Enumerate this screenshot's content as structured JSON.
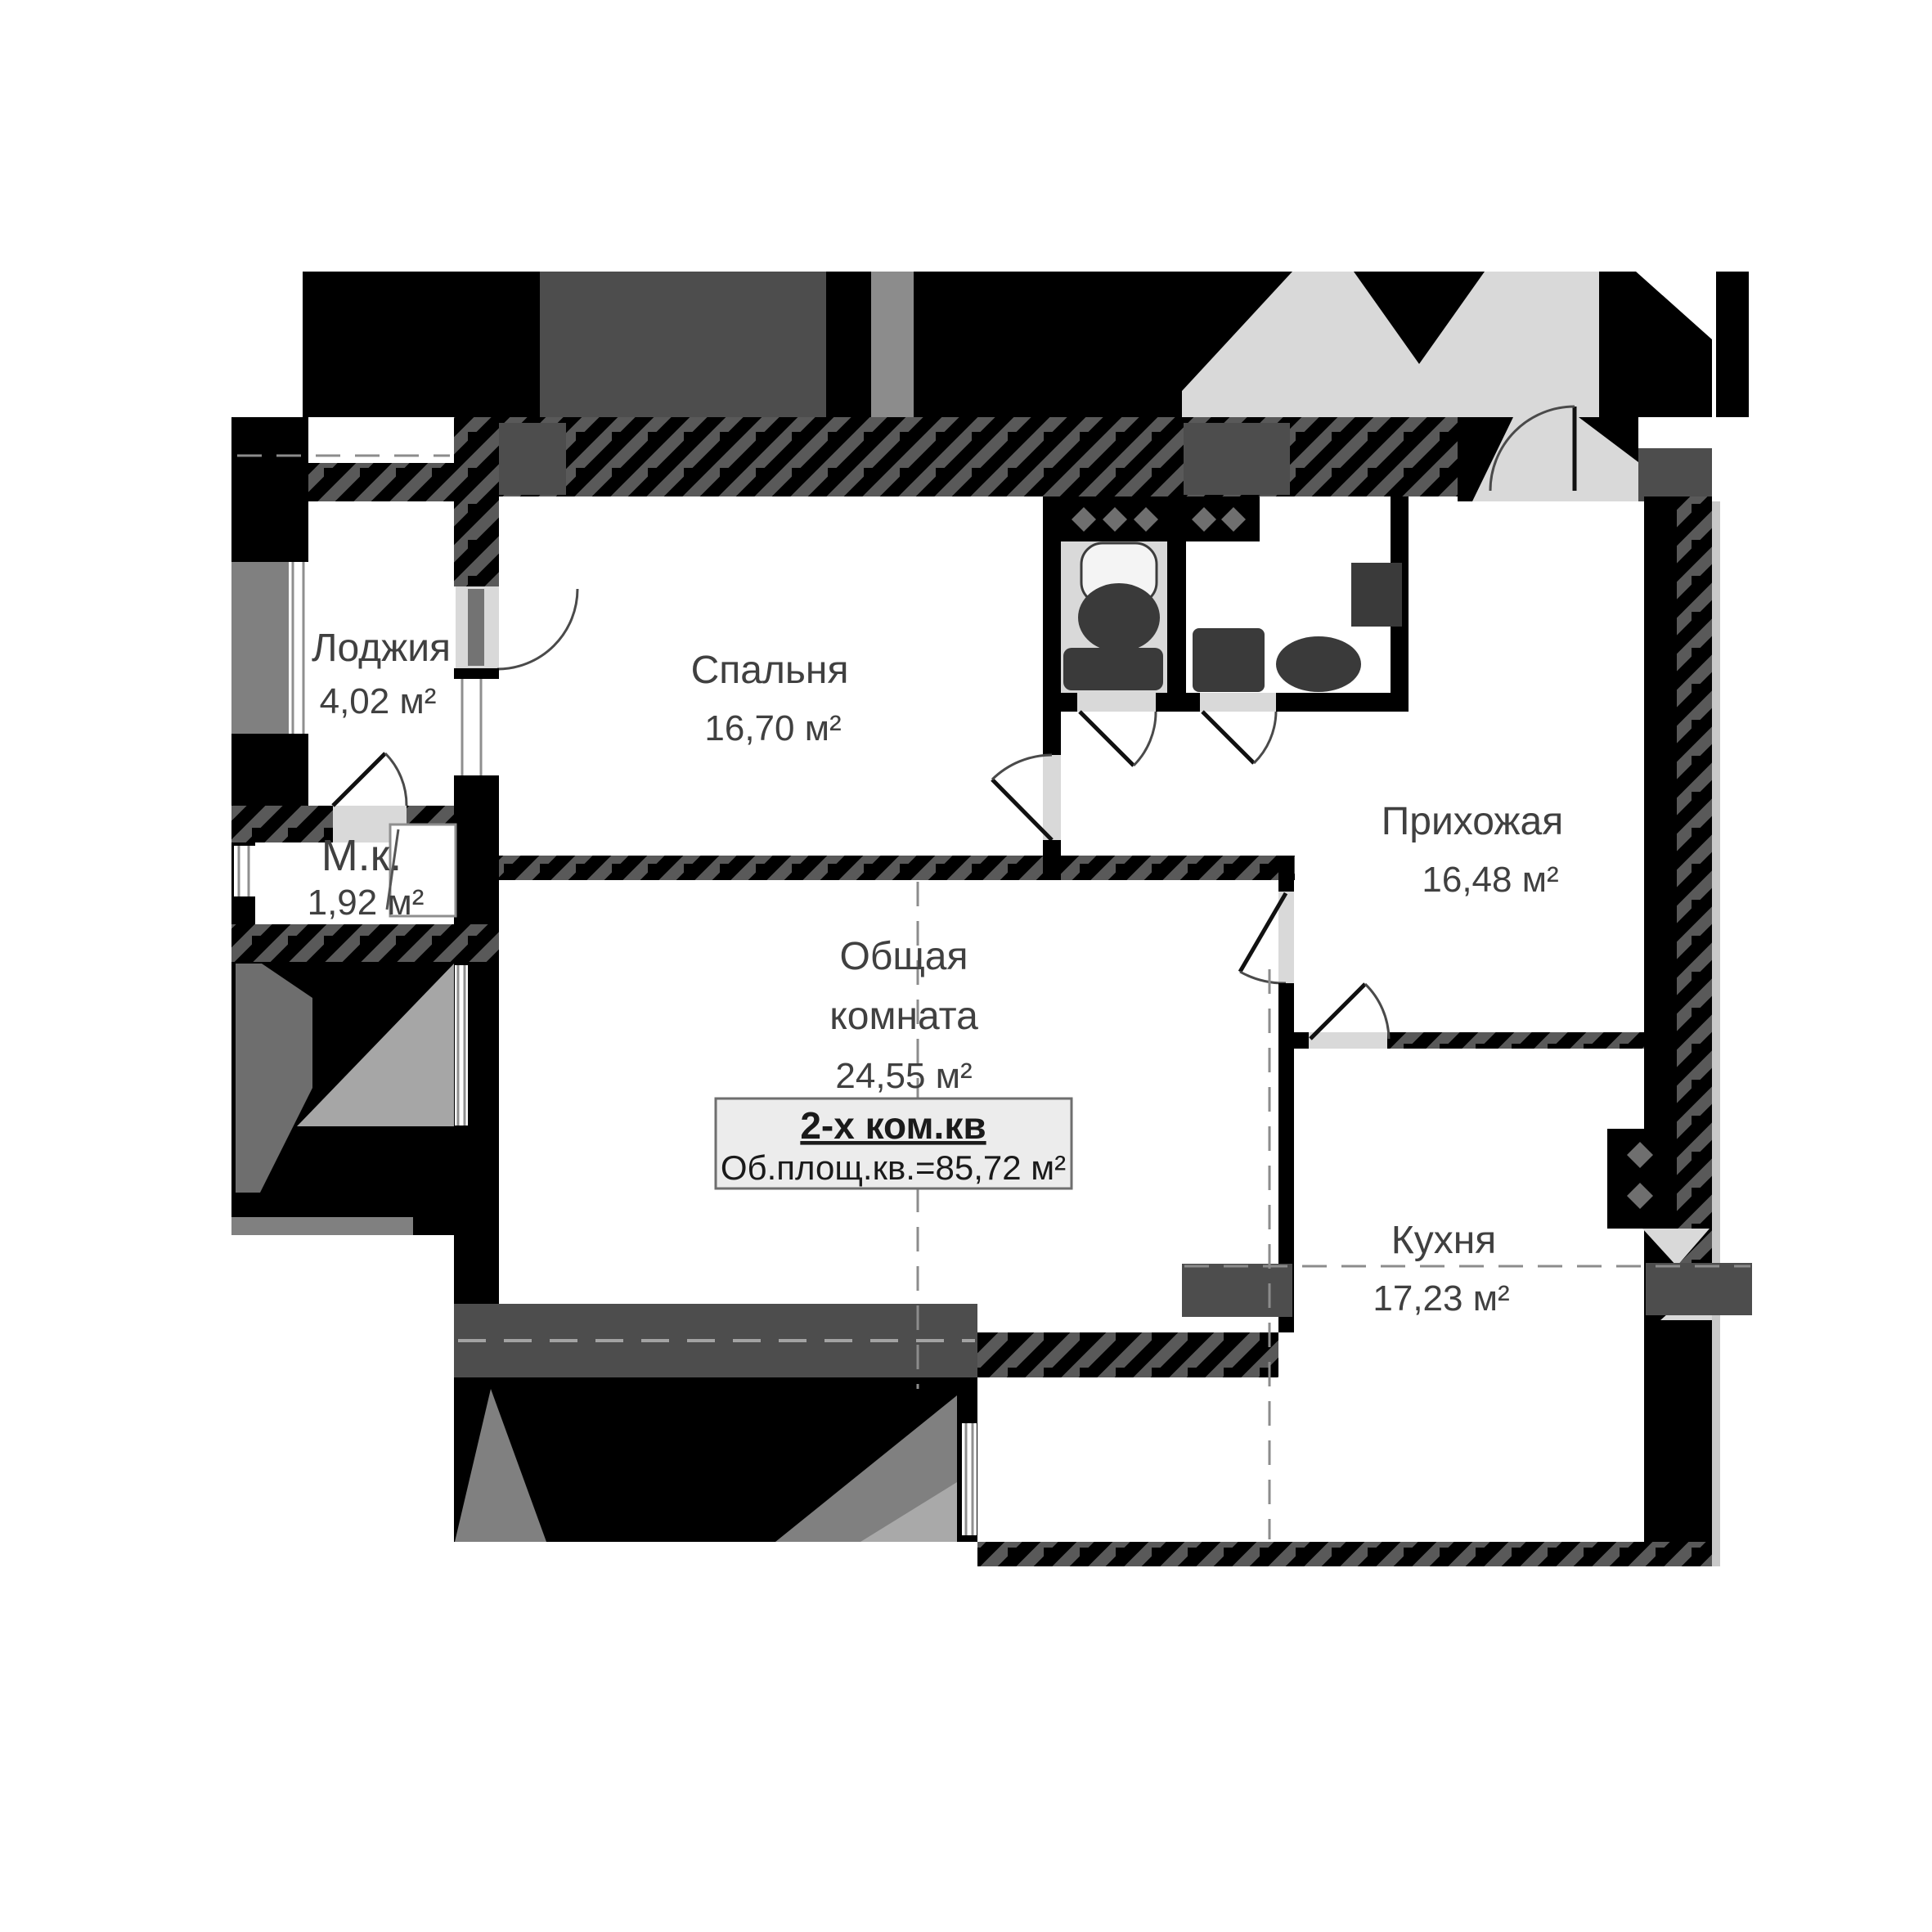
{
  "plan": {
    "type": "apartment-floor-plan",
    "rooms": {
      "loggia": {
        "name": "Лоджия",
        "area": "4,02 м²"
      },
      "bedroom": {
        "name": "Спальня",
        "area": "16,70 м²"
      },
      "mk": {
        "name": "М.к.",
        "area": "1,92 м²"
      },
      "living": {
        "name_line1": "Общая",
        "name_line2": "комната",
        "area": "24,55 м²"
      },
      "hallway": {
        "name": "Прихожая",
        "area": "16,48 м²"
      },
      "kitchen": {
        "name": "Кухня",
        "area": "17,23 м²"
      }
    },
    "info_box": {
      "title": "2-х ком.кв",
      "area_line": "Об.площ.кв.=85,72 м²"
    },
    "colors": {
      "wall": "#000000",
      "hatch": "#595959",
      "column": "#4d4d4d",
      "exterior_shade": "#808080",
      "light_shade": "#d9d9d9",
      "window_band": "#4d4d4d",
      "text": "#404040",
      "info_bg": "#ececec",
      "dashed_line": "#8c8c8c"
    }
  }
}
